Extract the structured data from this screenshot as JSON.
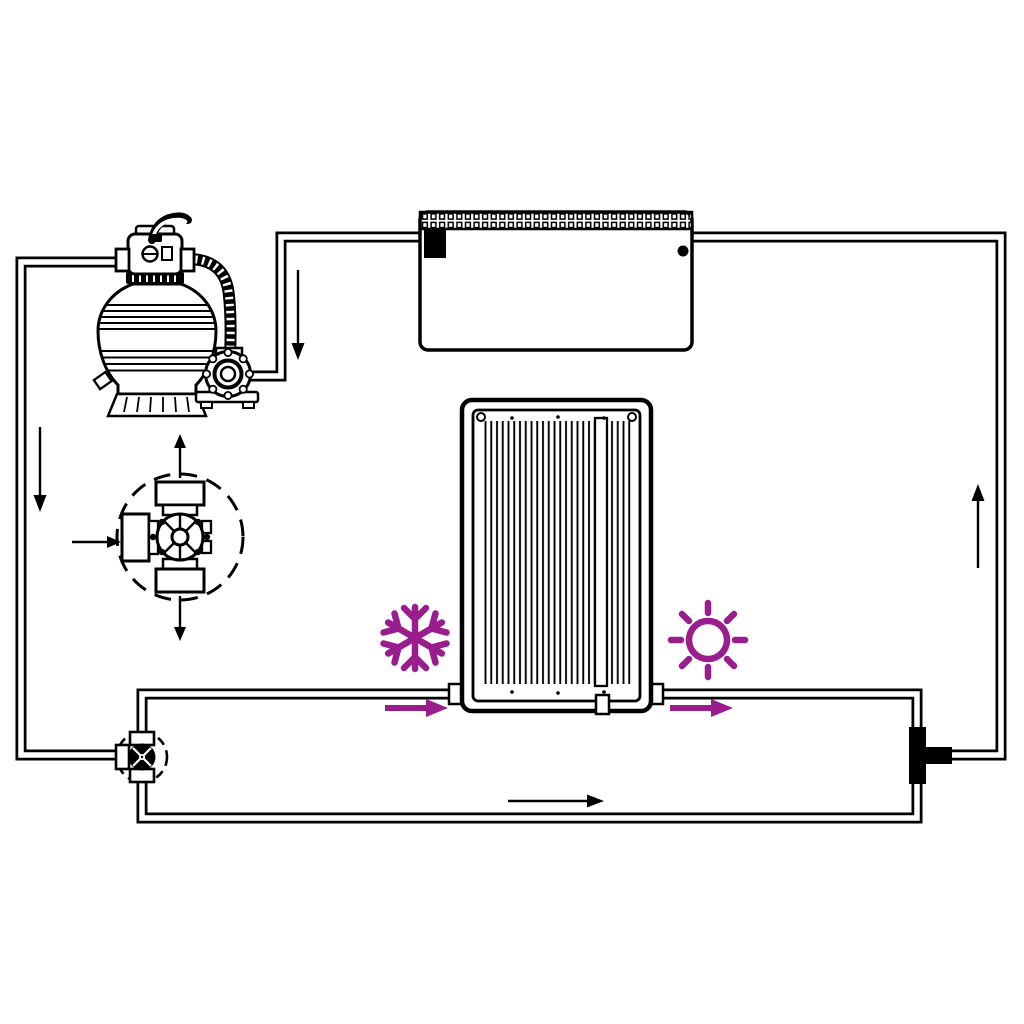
{
  "diagram": {
    "type": "schematic-line-drawing",
    "subject": "pool-solar-heater-circulation-loop",
    "canvas": {
      "width": 1024,
      "height": 1024,
      "background": "#ffffff"
    },
    "colors": {
      "line": "#000000",
      "accent": "#9a1d8e",
      "paper": "#ffffff"
    },
    "components": [
      {
        "id": "sand-filter-pump",
        "parts": [
          "valve-handle",
          "multiport-valve",
          "valve-left-port",
          "valve-right-port",
          "filter-tank",
          "corrugated-hose",
          "circulation-pump",
          "pump-base",
          "tank-skirt",
          "drain-fitting"
        ]
      },
      {
        "id": "multiport-valve-detail",
        "style": "dashed-circle-closeup",
        "flow_markers": [
          "arrow-in-left",
          "arrow-out-top",
          "arrow-out-bottom"
        ]
      },
      {
        "id": "swimming-pool",
        "parts": [
          "coping-edge",
          "skimmer-inlet",
          "return-jet"
        ]
      },
      {
        "id": "solar-collector-panel",
        "parts": [
          "outer-frame",
          "inner-frame",
          "tube-array",
          "section-divider",
          "left-port",
          "right-port",
          "bottom-connector",
          "corner-screws"
        ]
      },
      {
        "id": "bypass-three-way-valve",
        "style": "dashed-circle-junction"
      },
      {
        "id": "tee-connector",
        "style": "solid-black-fitting"
      }
    ],
    "icons": [
      {
        "name": "snowflake-icon",
        "meaning": "cold-water-before-panel",
        "color": "#9a1d8e"
      },
      {
        "name": "sun-icon",
        "meaning": "heated-water-after-panel",
        "color": "#9a1d8e"
      }
    ],
    "flow_arrows": {
      "black": [
        "down-pool-to-pump",
        "down-left-supply-line",
        "up-right-return-to-pool",
        "right-bottom-bypass-line"
      ],
      "accent": [
        "right-into-panel-inlet",
        "right-out-of-panel-outlet"
      ]
    }
  }
}
